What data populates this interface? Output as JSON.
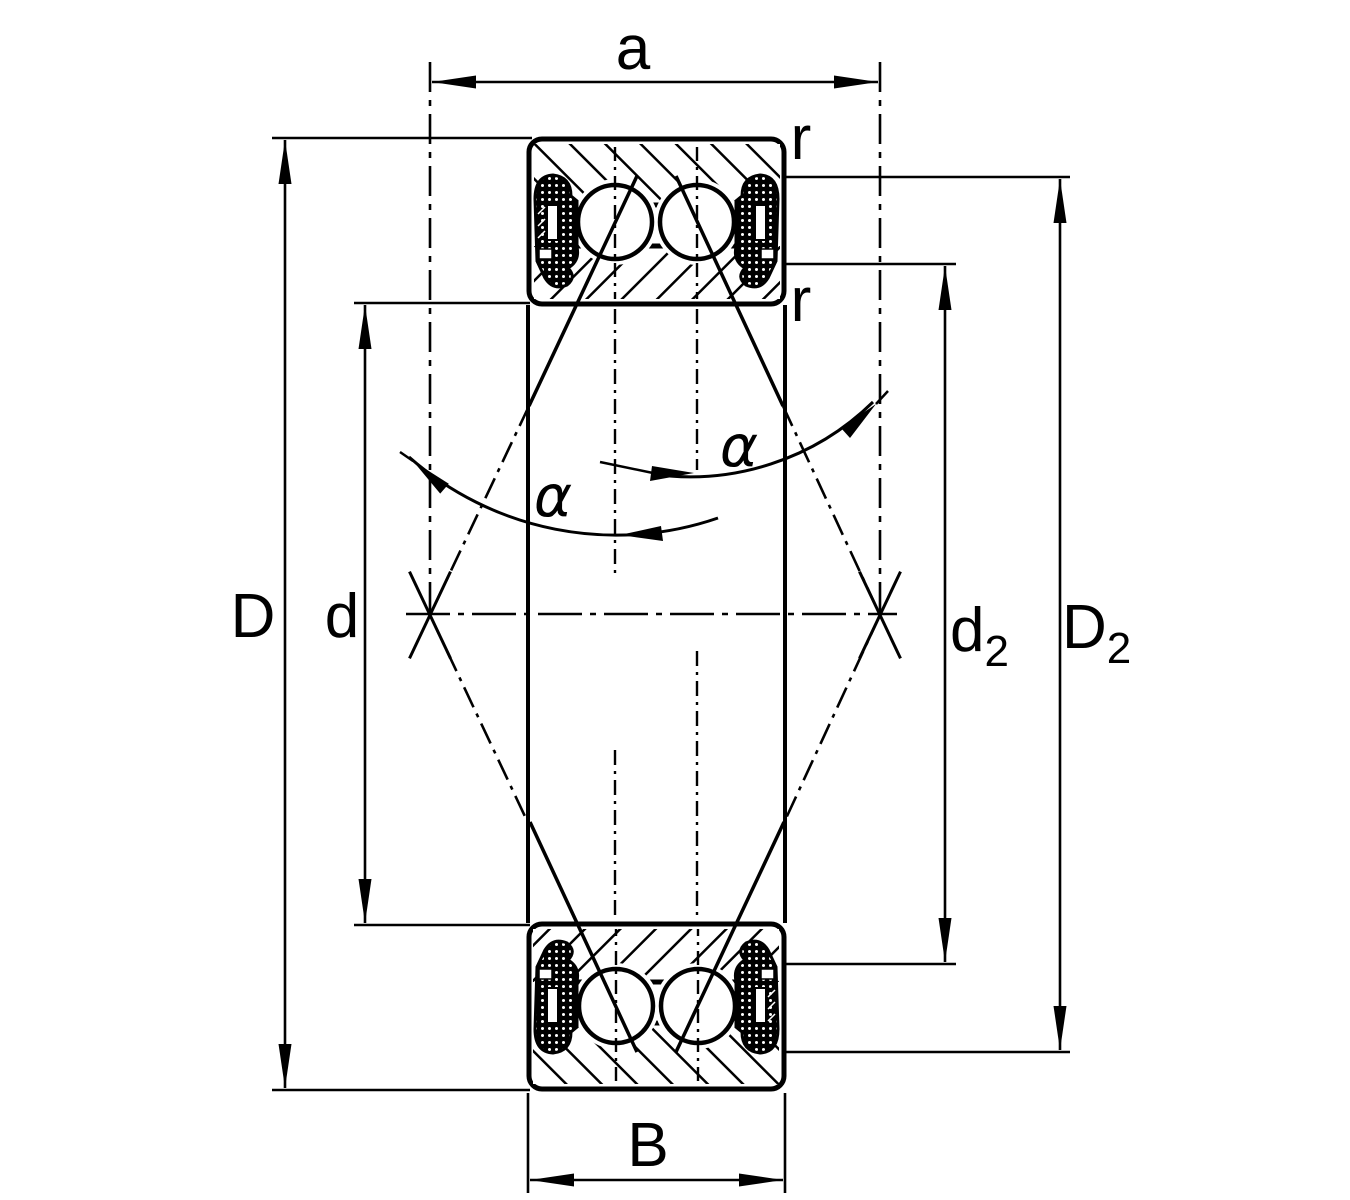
{
  "diagram": {
    "type": "engineering-drawing",
    "subject": "double-row angular contact ball bearing cross-section",
    "background": "#ffffff",
    "line_color": "#000000",
    "labels": {
      "dim_a": "a",
      "radius_top": "r",
      "radius_inner": "r",
      "dim_D": "D",
      "dim_d": "d",
      "dim_d2_base": "d",
      "dim_d2_sub": "2",
      "dim_D2_base": "D",
      "dim_D2_sub": "2",
      "dim_B": "B",
      "alpha_left": "α",
      "alpha_right": "α"
    }
  }
}
